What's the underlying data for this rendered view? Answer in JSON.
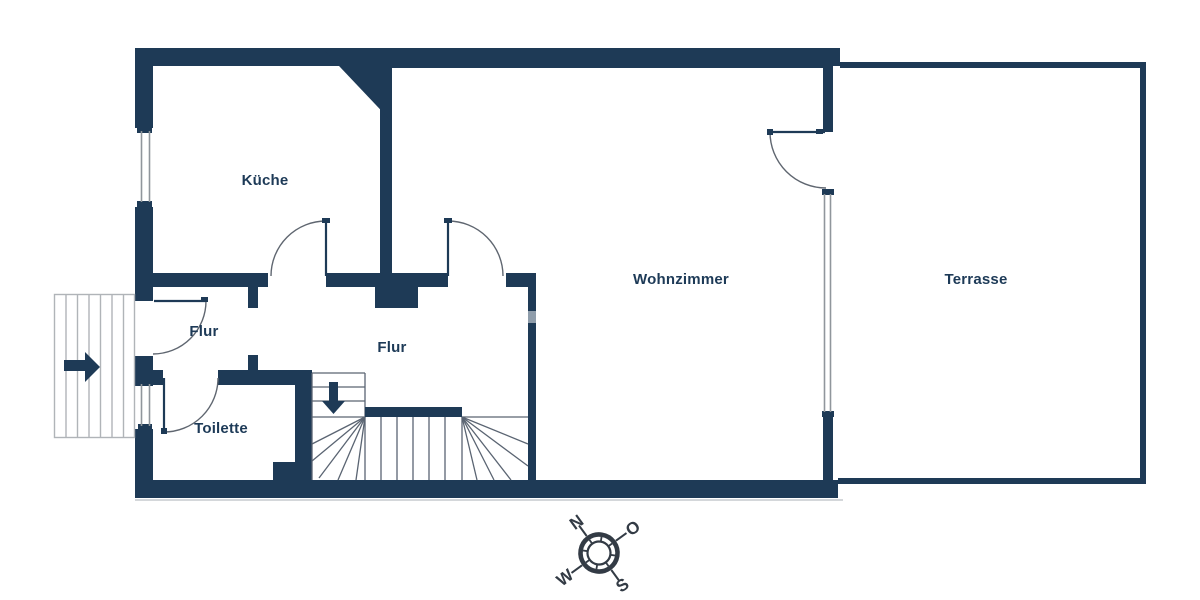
{
  "page": {
    "kind": "floor-plan"
  },
  "rooms": {
    "kitchen": {
      "label": "Küche"
    },
    "living_room": {
      "label": "Wohnzimmer"
    },
    "terrace": {
      "label": "Terrasse"
    },
    "hallway_entry": {
      "label": "Flur"
    },
    "hallway_main": {
      "label": "Flur"
    },
    "toilet": {
      "label": "Toilette"
    }
  },
  "compass": {
    "north": "N",
    "east": "O",
    "south": "S",
    "west": "W"
  },
  "icons": {
    "entry_direction_arrow": "right-arrow",
    "stairs_down_arrow": "down-arrow",
    "compass_rose": "compass-rose"
  },
  "colors": {
    "wall": "#1e3a56",
    "label_text": "#1d3a57",
    "exterior_stair_line": "#b0b4b8",
    "interior_stair_line": "#5a6472",
    "window_line": "#90969c",
    "door_arc": "#5f6670",
    "compass": "#333b45",
    "shadow_line": "#d4d7da",
    "background": "#ffffff"
  }
}
